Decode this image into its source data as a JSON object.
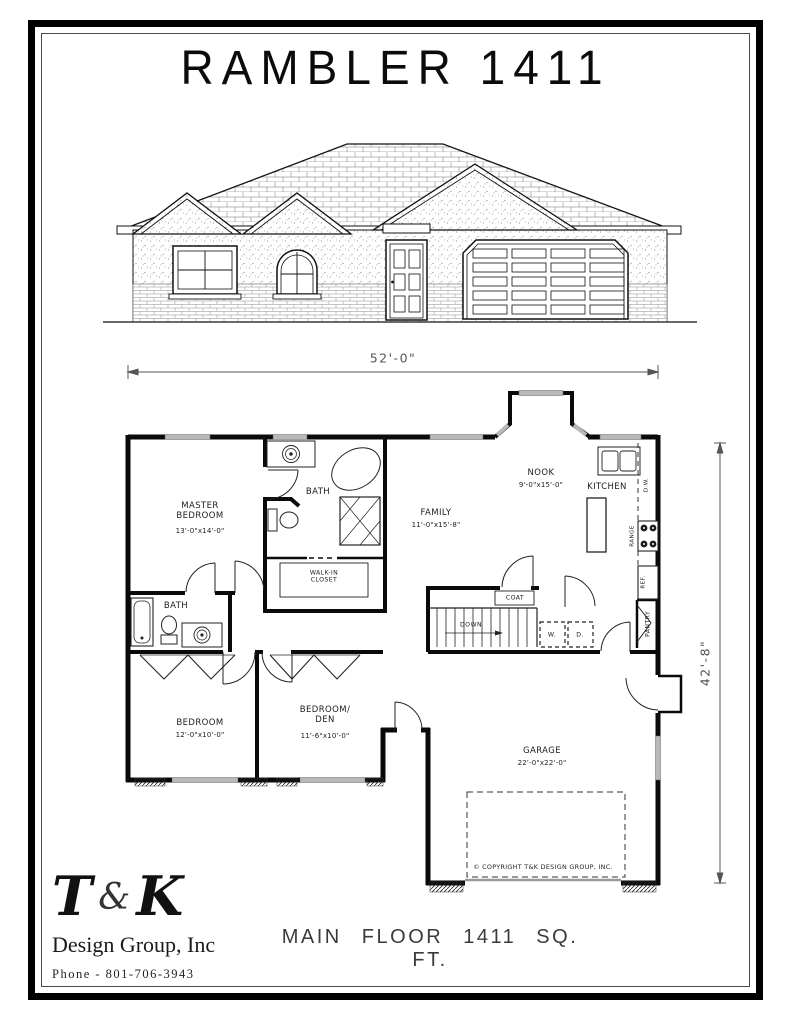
{
  "page": {
    "title": "RAMBLER 1411",
    "footer": "MAIN FLOOR 1411 SQ. FT.",
    "copyright": "© COPYRIGHT T&K DESIGN GROUP, INC."
  },
  "logo": {
    "t": "T",
    "amp": "&",
    "k": "K",
    "company": "Design Group, Inc",
    "phone": "Phone - 801-706-3943"
  },
  "dimensions": {
    "overall_width": "52'-0\"",
    "overall_depth": "42'-8\""
  },
  "rooms": {
    "master": {
      "name": "MASTER\nBEDROOM",
      "size": "13'-0\"x14'-0\""
    },
    "bath_master": {
      "name": "BATH"
    },
    "closet": {
      "name": "WALK-IN\nCLOSET"
    },
    "bath2": {
      "name": "BATH"
    },
    "bedroom": {
      "name": "BEDROOM",
      "size": "12'-0\"x10'-0\""
    },
    "den": {
      "name": "BEDROOM/\nDEN",
      "size": "11'-6\"x10'-0\""
    },
    "family": {
      "name": "FAMILY",
      "size": "11'-0\"x15'-8\""
    },
    "nook": {
      "name": "NOOK",
      "size": "9'-0\"x15'-0\""
    },
    "kitchen": {
      "name": "KITCHEN"
    },
    "garage": {
      "name": "GARAGE",
      "size": "22'-0\"x22'-0\""
    },
    "coat": {
      "name": "COAT"
    },
    "pantry": {
      "name": "PANTRY"
    },
    "stairs": {
      "name": "DOWN"
    },
    "washer": {
      "name": "W."
    },
    "dryer": {
      "name": "D."
    },
    "dishwasher": {
      "name": "D.W."
    },
    "range": {
      "name": "RANGE"
    },
    "fridge": {
      "name": "REF."
    }
  },
  "colors": {
    "ink": "#111111",
    "dim": "#555555",
    "window_fill": "#b9b9b9"
  }
}
